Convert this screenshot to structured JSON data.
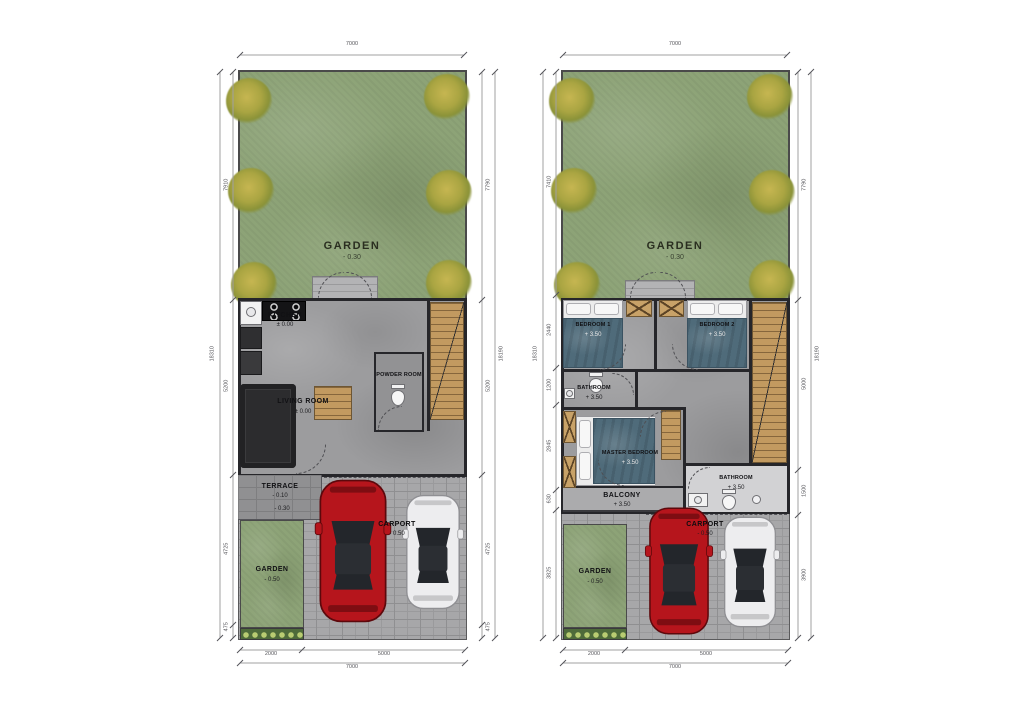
{
  "figure": {
    "type": "architectural-floor-plans",
    "background": "#ffffff"
  },
  "colors": {
    "grass": "#8da377",
    "tree": "#aaa542",
    "concrete": "#9c9c9e",
    "pavers": "#a7a7a9",
    "wood": "#c29a60",
    "wall": "#26262a",
    "blanket": "#4f6b7a",
    "car_red": "#b6151c",
    "car_white": "#ededef",
    "dimension": "#55555a"
  },
  "plans": [
    {
      "name": "ground-floor",
      "rooms": {
        "garden_main": {
          "label": "GARDEN",
          "level": "- 0.30"
        },
        "kitchen": {
          "label": "KITCHEN",
          "level": "± 0.00"
        },
        "living_room": {
          "label": "LIVING ROOM",
          "level": "± 0.00"
        },
        "powder_room": {
          "label": "POWDER ROOM"
        },
        "terrace": {
          "label": "TERRACE",
          "level": "- 0.10",
          "step_level": "- 0.30"
        },
        "garden_front": {
          "label": "GARDEN",
          "level": "- 0.50"
        },
        "carport": {
          "label": "CARPORT",
          "level": "- 0.50"
        }
      },
      "dims": {
        "top_outer": "7000",
        "left_outer": "18310",
        "left_inner": [
          "7910",
          "5200",
          "4725",
          "475"
        ],
        "right_outer": "18190",
        "right_inner": [
          "7790",
          "5200",
          "4725",
          "475"
        ],
        "bottom_inner": [
          "2000",
          "5000"
        ],
        "bottom_outer": "7000"
      }
    },
    {
      "name": "upper-floor",
      "rooms": {
        "garden_main": {
          "label": "GARDEN",
          "level": "- 0.30"
        },
        "bedroom1": {
          "label": "BEDROOM 1",
          "level": "+ 3.50"
        },
        "bedroom2": {
          "label": "BEDROOM 2",
          "level": "+ 3.50"
        },
        "bathroom_upper": {
          "label": "BATHROOM",
          "level": "+ 3.50"
        },
        "master_bedroom": {
          "label": "MASTER BEDROOM",
          "level": "+ 3.50"
        },
        "balcony": {
          "label": "BALCONY",
          "level": "+ 3.50"
        },
        "bathroom_lower": {
          "label": "BATHROOM",
          "level": "+ 3.50"
        },
        "garden_front": {
          "label": "GARDEN",
          "level": "- 0.50"
        },
        "carport": {
          "label": "CARPORT",
          "level": "- 0.50"
        }
      },
      "dims": {
        "top_outer": "7000",
        "left_outer": "18310",
        "left_inner": [
          "7410",
          "2440",
          "1200",
          "2845",
          "630",
          "3825"
        ],
        "right_outer": "18190",
        "right_inner": [
          "7790",
          "5000",
          "1500",
          "3900"
        ],
        "bottom_inner": [
          "2000",
          "5000"
        ],
        "bottom_outer": "7000"
      }
    }
  ]
}
